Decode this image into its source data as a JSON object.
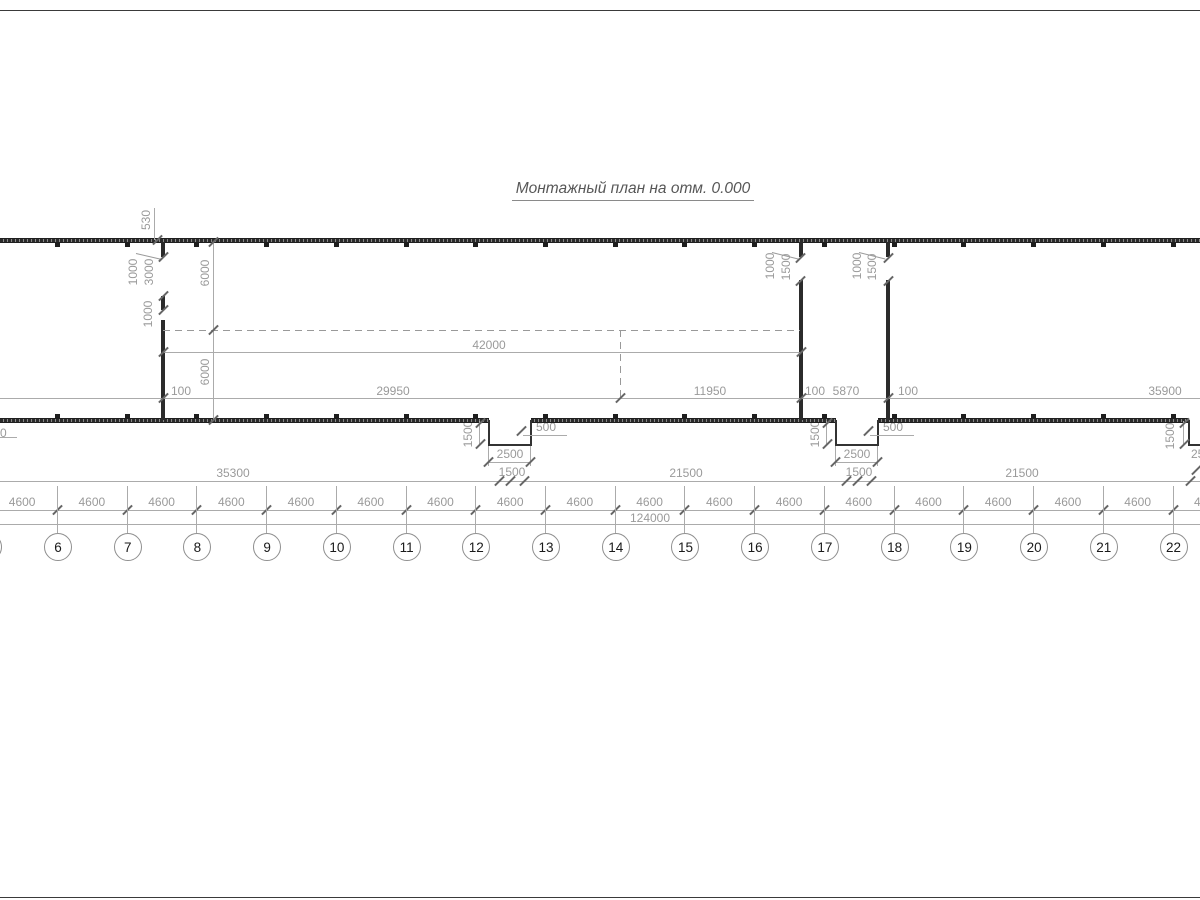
{
  "title": "Монтажный план на отм. 0.000",
  "axis_labels": [
    "6",
    "7",
    "8",
    "9",
    "10",
    "11",
    "12",
    "13",
    "14",
    "15",
    "16",
    "17",
    "18",
    "19",
    "20",
    "21",
    "22"
  ],
  "bay_label": "4600",
  "dims": {
    "d530": "530",
    "d1000": "1000",
    "d3000": "3000",
    "d6000": "6000",
    "d100": "100",
    "d29950": "29950",
    "d42000": "42000",
    "d11950": "11950",
    "d5870": "5870",
    "d35900": "35900",
    "d1500": "1500",
    "d500": "500",
    "d2500": "2500",
    "d35300": "35300",
    "d21500": "21500",
    "d124000": "124000",
    "d0cut": "0"
  },
  "colors": {
    "wall": "#2b2b2b",
    "dim_line": "#aaaaaa",
    "dim_text": "#9a9a9a",
    "axis_text": "#1a1a1a"
  }
}
